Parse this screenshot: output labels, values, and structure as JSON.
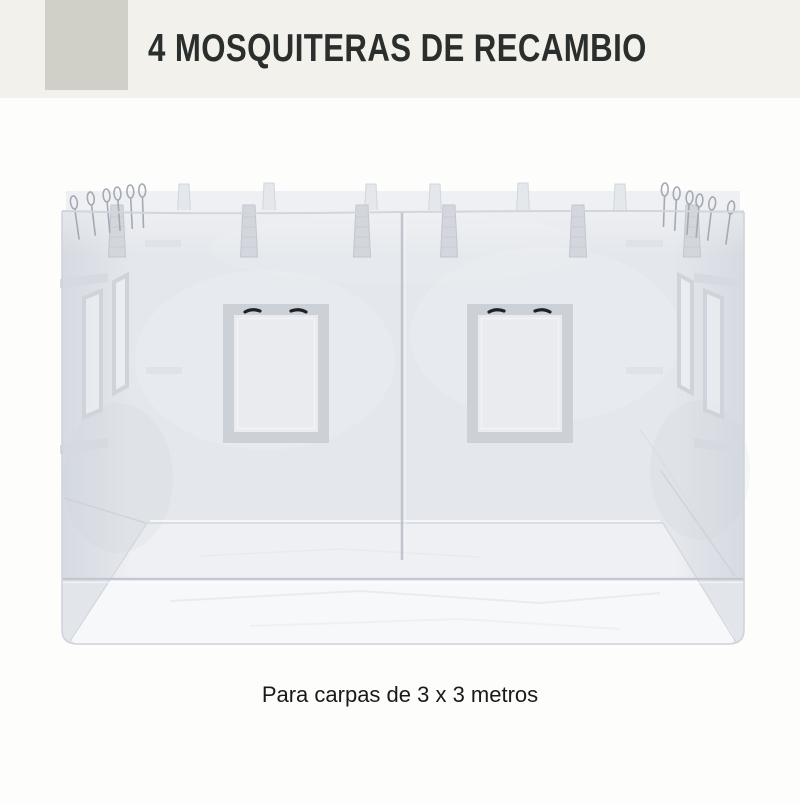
{
  "header": {
    "title": "4 MOSQUITERAS DE RECAMBIO",
    "background": "#f2f1ec",
    "accent_square_color": "#d0d0c8",
    "title_color": "#2a2f2d"
  },
  "product_image": {
    "subject": "replacement-mosquito-net-panels",
    "colors": {
      "mesh": "#e4e7ec",
      "mesh_band": "#eef0f4",
      "floor_through_mesh": "#eef0f3",
      "floor": "#f7f8fa",
      "skirt": "#e2e5ea",
      "frame_gray": "#ccd0d7",
      "window_inner": "#e9ebee",
      "outline": "#ced2d9",
      "seam": "#c0c4cc",
      "strap_front": "#d3d6dd",
      "strap_back": "#e4e7eb",
      "loop_cord": "#a4aab3",
      "zipper_pull": "#1f2123"
    }
  },
  "caption": {
    "text": "Para carpas de 3 x 3 metros",
    "color": "#1a1a1a"
  }
}
